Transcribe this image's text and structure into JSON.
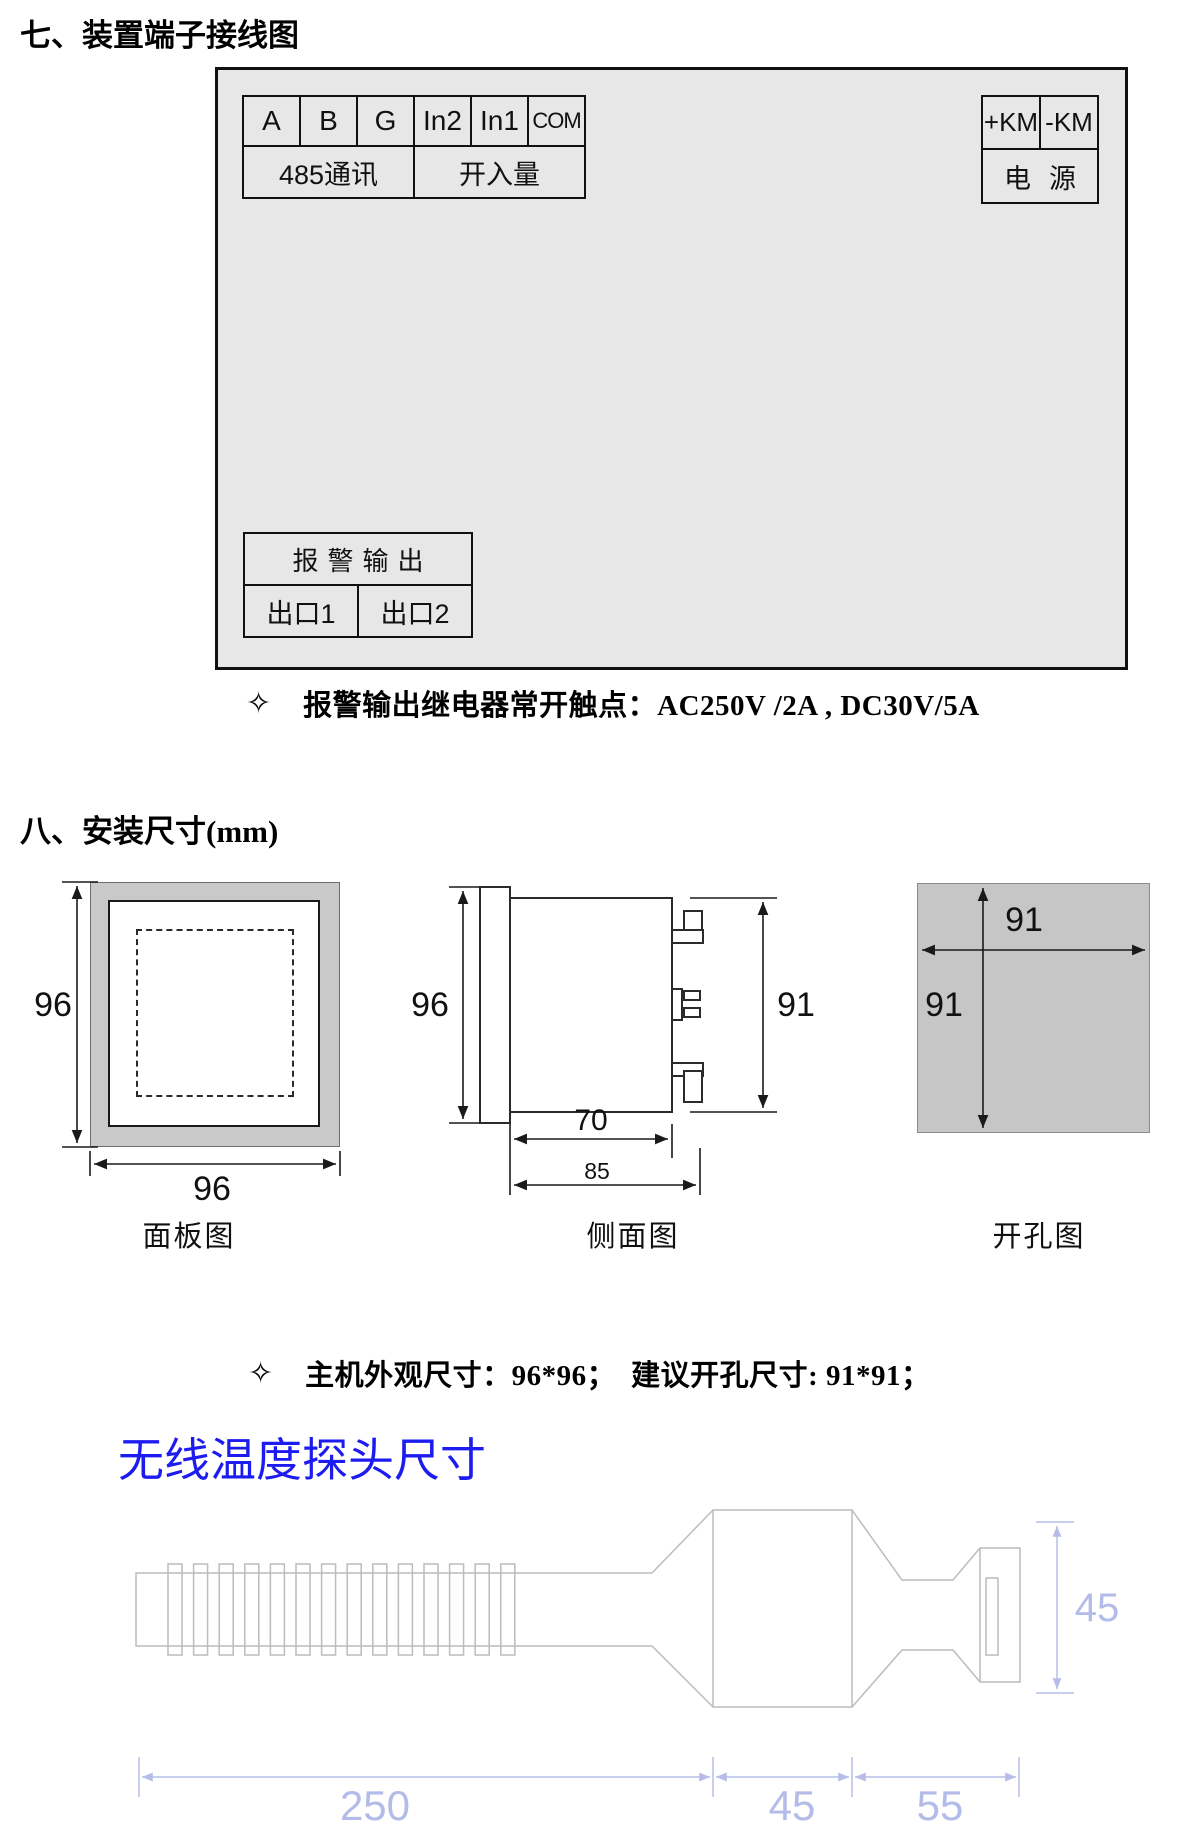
{
  "section7": {
    "heading": "七、装置端子接线图",
    "bullet": "✧",
    "note": "报警输出继电器常开触点：AC250V /2A , DC30V/5A",
    "wiring": {
      "terminals": [
        "A",
        "B",
        "G",
        "In2",
        "In1",
        "COM"
      ],
      "group_485": "485通讯",
      "group_di": "开入量",
      "km_plus": "+KM",
      "km_minus": "-KM",
      "power": "电源",
      "alarm_header": "报警输出",
      "outlet1": "出口1",
      "outlet2": "出口2"
    }
  },
  "section8": {
    "heading": "八、安装尺寸(mm)",
    "bullet": "✧",
    "note": "主机外观尺寸：96*96；　建议开孔尺寸: 91*91；",
    "panel": {
      "caption": "面板图",
      "dim_h": "96",
      "dim_w": "96"
    },
    "side": {
      "caption": "侧面图",
      "dim_h": "96",
      "dim_r": "91",
      "dim_70": "70",
      "dim_85": "85"
    },
    "cutout": {
      "caption": "开孔图",
      "dim_w": "91",
      "dim_h": "91"
    }
  },
  "probe": {
    "heading": "无线温度探头尺寸",
    "dim_length": "250",
    "dim_mid": "45",
    "dim_head": "55",
    "dim_height": "45"
  },
  "colors": {
    "accent_blue": "#1c1cf0",
    "dimension_blue": "#b6bde9"
  }
}
